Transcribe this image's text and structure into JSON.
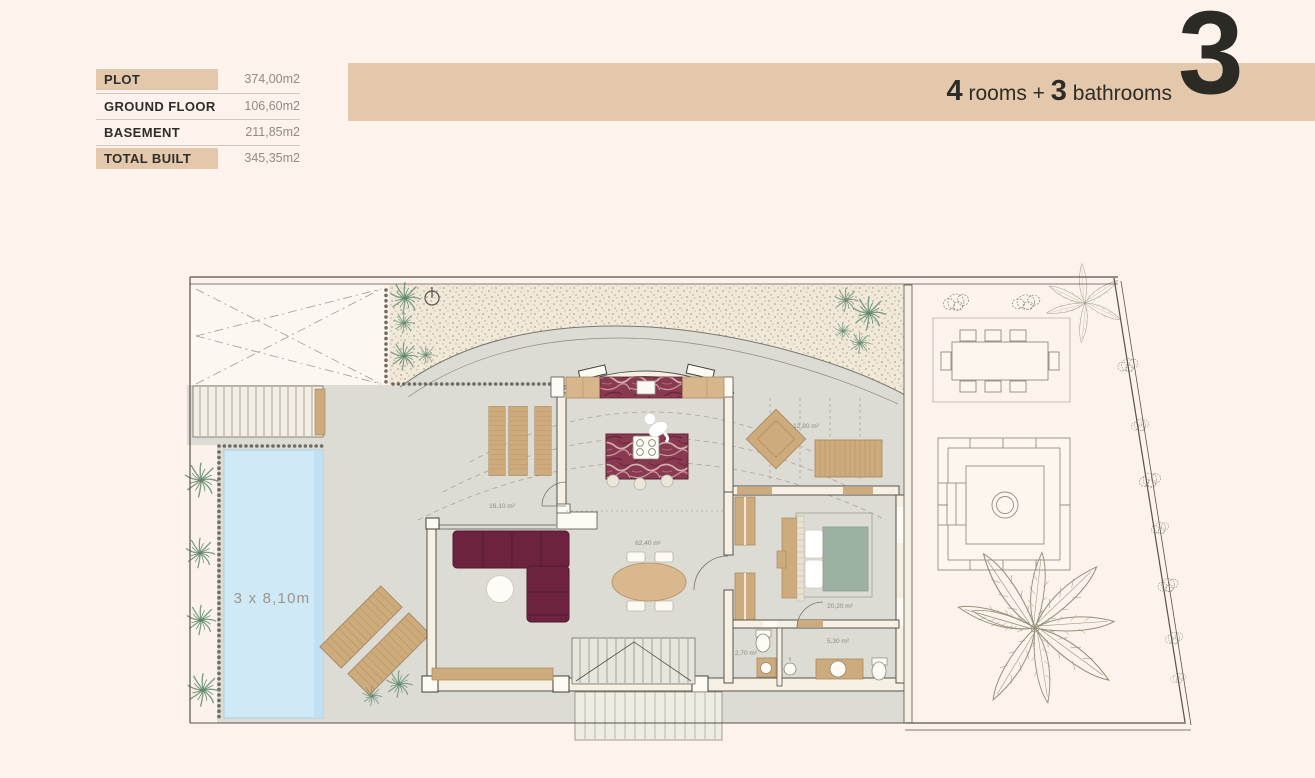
{
  "page": {
    "colors": {
      "background": "#fdf3ec",
      "accent_tan": "#e4c8ab",
      "text_dark": "#2e2c27",
      "text_gray": "#8f8c83",
      "floor_gray": "#dcdbd4",
      "gravel_cream": "#f0e9da",
      "pool_blue": "#cfe9f6",
      "sofa_burgundy": "#6d2340",
      "marble_burgundy": "#8a3a50",
      "bed_sage": "#9cb1a1",
      "wood_tan": "#cdab7d"
    }
  },
  "area_table": {
    "rows": [
      {
        "label": "PLOT",
        "value": "374,00m2"
      },
      {
        "label": "GROUND FLOOR",
        "value": "106,60m2"
      },
      {
        "label": "BASEMENT",
        "value": "211,85m2"
      },
      {
        "label": "TOTAL BUILT",
        "value": "345,35m2"
      }
    ]
  },
  "banner": {
    "rooms_count": "4",
    "rooms_label": " rooms + ",
    "bath_count": "3",
    "bath_label": " bathrooms",
    "floor_number": "3"
  },
  "plan": {
    "pool_label": "3 x 8,10m",
    "room_labels": {
      "terrace": "16,10 m²",
      "living": "62,40 m²",
      "outdoor": "12,80 m²",
      "bedroom": "20,20 m²",
      "wc": "2,70 m²",
      "bathroom": "5,30 m²"
    }
  }
}
